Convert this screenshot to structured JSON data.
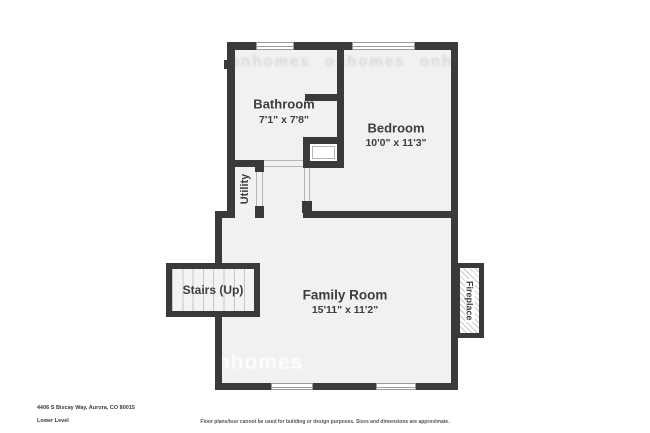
{
  "rooms": {
    "bathroom": {
      "label": "Bathroom",
      "dims": "7'1\" x 7'8\""
    },
    "bedroom": {
      "label": "Bedroom",
      "dims": "10'0\" x 11'3\""
    },
    "family_room": {
      "label": "Family Room",
      "dims": "15'11\" x 11'2\""
    },
    "utility": {
      "label": "Utility"
    },
    "stairs": {
      "label": "Stairs (Up)"
    },
    "fireplace": {
      "label": "Fireplace"
    }
  },
  "footer": {
    "address": "4406 S Biscay Way, Aurora, CO 80015",
    "level": "Lower Level",
    "disclaimer": "Floor plans/tour cannot be used for building or design purposes. Sizes and dimensions are approximate."
  },
  "watermark": {
    "fragment": "onhomes"
  },
  "colors": {
    "wall": "#3a3a3a",
    "floor": "#f1f1f0",
    "label_text": "#3d3d3d",
    "thin_line": "#b5b5b5"
  }
}
